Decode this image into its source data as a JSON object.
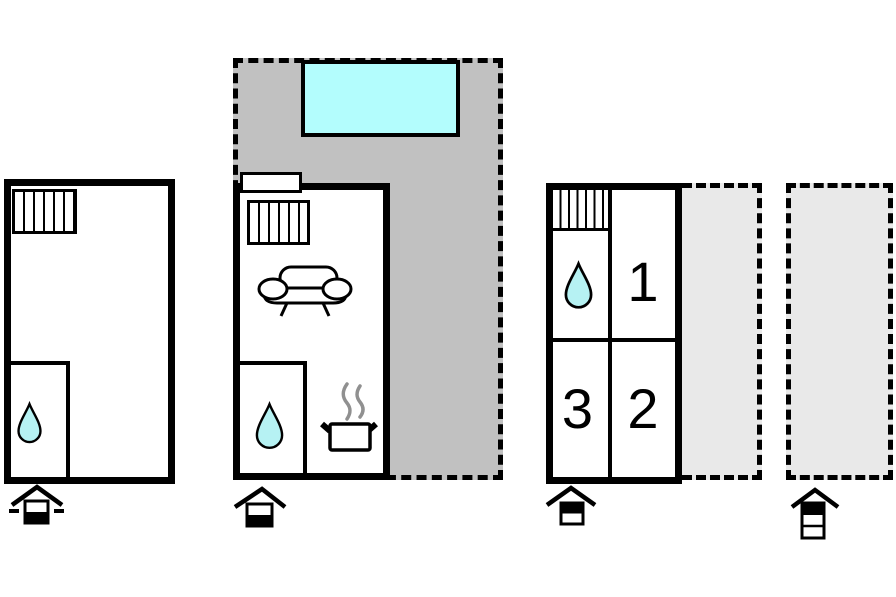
{
  "canvas": {
    "width": 896,
    "height": 597
  },
  "colors": {
    "wall": "#000000",
    "background": "#ffffff",
    "terrace-dark": "#c1c1c1",
    "terrace-light": "#e9e9e9",
    "pool": "#b3fdfd",
    "drop": "#b6f2f3",
    "steam": "#909090",
    "digit": "#000000"
  },
  "buildings": {
    "left": {
      "icons": [
        "window-hatch",
        "water-drop"
      ],
      "storey_indicator": {
        "storeys": 2,
        "filled_level": "bottom",
        "side_dashes": true
      }
    },
    "middle": {
      "icons": [
        "window",
        "window-hatch",
        "sofa",
        "water-drop",
        "cooking-pot",
        "swimming-pool",
        "terrace"
      ],
      "storey_indicator": {
        "storeys": 2,
        "filled_level": "bottom",
        "side_dashes": false
      }
    },
    "right": {
      "rooms": [
        {
          "label": "1"
        },
        {
          "label": "2"
        },
        {
          "label": "3"
        }
      ],
      "icons": [
        "window-hatch",
        "water-drop"
      ],
      "storey_indicator": {
        "storeys": 2,
        "filled_level": "top",
        "side_dashes": false
      }
    },
    "outdoor": {
      "terrace_count": 2,
      "storey_indicator": {
        "storeys": 3,
        "filled_level": "top",
        "side_dashes": false
      }
    }
  }
}
